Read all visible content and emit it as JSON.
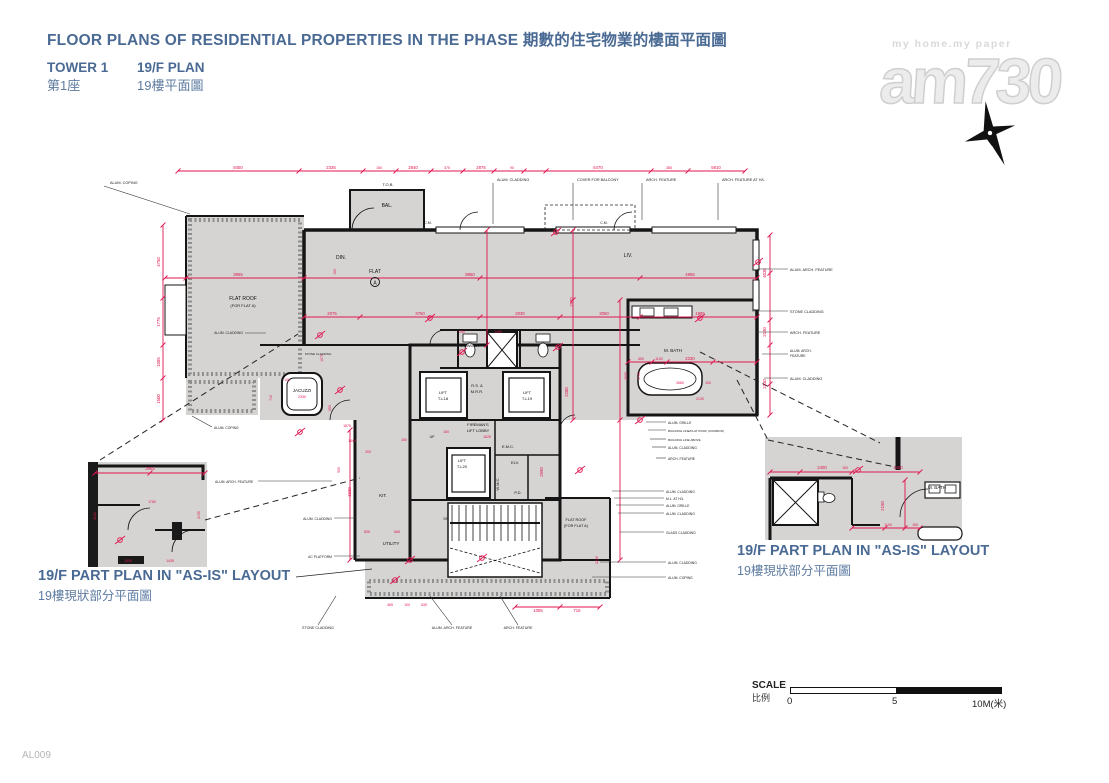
{
  "colors": {
    "accent_blue": "#4a6a94",
    "dim_red": "#e0164f",
    "floor_gray": "#d6d4d2",
    "wall_black": "#151515"
  },
  "header": {
    "title": "FLOOR PLANS OF RESIDENTIAL PROPERTIES IN THE PHASE 期數的住宅物業的樓面平面圖",
    "tower_en": "TOWER 1",
    "floor_en": "19/F PLAN",
    "tower_zh": "第1座",
    "floor_zh": "19樓平面圖"
  },
  "watermark": {
    "tagline": "my home.my paper",
    "brand": "am730"
  },
  "sheet_code": "AL009",
  "part_plans": {
    "left": {
      "en": "19/F PART PLAN IN \"AS-IS\" LAYOUT",
      "zh": "19樓現狀部分平面圖"
    },
    "right": {
      "en": "19/F PART PLAN IN \"AS-IS\" LAYOUT",
      "zh": "19樓現狀部分平面圖"
    }
  },
  "scale": {
    "en": "SCALE",
    "zh": "比例",
    "t0": "0",
    "t5": "5",
    "t10": "10M(米)"
  },
  "plan": {
    "unit": "A",
    "dims": [
      {
        "t": "8450",
        "x": 238,
        "y": 169
      },
      {
        "t": "2335",
        "x": 331,
        "y": 169
      },
      {
        "t": "150",
        "x": 379,
        "y": 169,
        "s": 3.5
      },
      {
        "t": "2840",
        "x": 413,
        "y": 169
      },
      {
        "t": "375",
        "x": 447,
        "y": 169,
        "s": 3.5
      },
      {
        "t": "2875",
        "x": 481,
        "y": 169
      },
      {
        "t": "90",
        "x": 512,
        "y": 169,
        "s": 3.5
      },
      {
        "t": "6470",
        "x": 598,
        "y": 169
      },
      {
        "t": "385",
        "x": 669,
        "y": 169,
        "s": 3.5
      },
      {
        "t": "5810",
        "x": 716,
        "y": 169
      },
      {
        "t": "4750",
        "x": 160,
        "y": 262,
        "r": -90
      },
      {
        "t": "1775",
        "x": 160,
        "y": 322,
        "r": -90
      },
      {
        "t": "1085",
        "x": 160,
        "y": 362,
        "r": -90
      },
      {
        "t": "1500",
        "x": 160,
        "y": 399,
        "r": -90
      },
      {
        "t": "3965",
        "x": 238,
        "y": 276
      },
      {
        "t": "8950",
        "x": 470,
        "y": 276
      },
      {
        "t": "4955",
        "x": 690,
        "y": 276
      },
      {
        "t": "150",
        "x": 336,
        "y": 272,
        "r": -90,
        "s": 3.5
      },
      {
        "t": "2075",
        "x": 332,
        "y": 315
      },
      {
        "t": "3750",
        "x": 420,
        "y": 315
      },
      {
        "t": "2030",
        "x": 520,
        "y": 315
      },
      {
        "t": "3050",
        "x": 604,
        "y": 315
      },
      {
        "t": "1985",
        "x": 700,
        "y": 315
      },
      {
        "t": "4030",
        "x": 766,
        "y": 273,
        "r": -90
      },
      {
        "t": "2130",
        "x": 766,
        "y": 332,
        "r": -90
      },
      {
        "t": "2330",
        "x": 766,
        "y": 384,
        "r": -90
      },
      {
        "t": "650",
        "x": 641,
        "y": 360,
        "s": 3.5
      },
      {
        "t": "1100",
        "x": 659,
        "y": 360,
        "s": 3.5
      },
      {
        "t": "2330",
        "x": 690,
        "y": 360
      },
      {
        "t": "2680",
        "x": 680,
        "y": 384,
        "s": 3.5
      },
      {
        "t": "100",
        "x": 708,
        "y": 384,
        "s": 3.5
      },
      {
        "t": "2130",
        "x": 700,
        "y": 400,
        "s": 3.5
      },
      {
        "t": "250",
        "x": 462,
        "y": 333,
        "s": 3.5
      },
      {
        "t": "1400",
        "x": 498,
        "y": 333,
        "s": 3.5
      },
      {
        "t": "2970",
        "x": 573,
        "y": 302,
        "r": -90
      },
      {
        "t": "2280",
        "x": 568,
        "y": 392,
        "r": -90
      },
      {
        "t": "1625",
        "x": 487,
        "y": 438,
        "s": 3.5
      },
      {
        "t": "150",
        "x": 446,
        "y": 433,
        "s": 3.5
      },
      {
        "t": "2590",
        "x": 543,
        "y": 472,
        "r": -90
      },
      {
        "t": "2330",
        "x": 302,
        "y": 398,
        "s": 3.5
      },
      {
        "t": "100",
        "x": 287,
        "y": 381,
        "s": 3.5
      },
      {
        "t": "655",
        "x": 331,
        "y": 408,
        "r": -90,
        "s": 3.5
      },
      {
        "t": "715",
        "x": 272,
        "y": 398,
        "r": -90,
        "s": 3.5
      },
      {
        "t": "1075",
        "x": 323,
        "y": 358,
        "r": -90,
        "s": 3.5
      },
      {
        "t": "1440",
        "x": 352,
        "y": 442,
        "s": 3.5
      },
      {
        "t": "905",
        "x": 340,
        "y": 470,
        "r": -90,
        "s": 3.5
      },
      {
        "t": "200",
        "x": 368,
        "y": 453,
        "s": 3.5
      },
      {
        "t": "1875",
        "x": 347,
        "y": 427,
        "s": 3.5
      },
      {
        "t": "3330",
        "x": 351,
        "y": 492,
        "r": -90
      },
      {
        "t": "665",
        "x": 397,
        "y": 533,
        "s": 3.5
      },
      {
        "t": "805",
        "x": 367,
        "y": 533,
        "s": 3.5
      },
      {
        "t": "150",
        "x": 404,
        "y": 441,
        "s": 3.5
      },
      {
        "t": "465",
        "x": 390,
        "y": 606,
        "s": 3.5
      },
      {
        "t": "100",
        "x": 407,
        "y": 606,
        "s": 3.5
      },
      {
        "t": "635",
        "x": 424,
        "y": 606,
        "s": 3.5
      },
      {
        "t": "1085",
        "x": 538,
        "y": 612
      },
      {
        "t": "715",
        "x": 577,
        "y": 612
      },
      {
        "t": "2230",
        "x": 598,
        "y": 560,
        "r": -90,
        "s": 3.5
      },
      {
        "t": "3965",
        "x": 150,
        "y": 470
      },
      {
        "t": "1780",
        "x": 152,
        "y": 503,
        "s": 3.5
      },
      {
        "t": "2195",
        "x": 200,
        "y": 515,
        "r": -90,
        "s": 3.5
      },
      {
        "t": "1430",
        "x": 128,
        "y": 562,
        "s": 3.5
      },
      {
        "t": "1435",
        "x": 170,
        "y": 562,
        "s": 3.5
      },
      {
        "t": "3100",
        "x": 96,
        "y": 516,
        "r": -90,
        "s": 3.5
      },
      {
        "t": "2400",
        "x": 822,
        "y": 469
      },
      {
        "t": "150",
        "x": 845,
        "y": 469,
        "s": 3.5
      },
      {
        "t": "4400",
        "x": 898,
        "y": 469
      },
      {
        "t": "2190",
        "x": 884,
        "y": 506,
        "r": -90
      },
      {
        "t": "1100",
        "x": 888,
        "y": 526,
        "s": 3.5
      },
      {
        "t": "150",
        "x": 915,
        "y": 526,
        "s": 3.5
      },
      {
        "t": "2690",
        "x": 627,
        "y": 376,
        "r": -90,
        "s": 3.5
      },
      {
        "t": "1700",
        "x": 640,
        "y": 376,
        "r": -90,
        "s": 3.5
      }
    ],
    "rooms": [
      {
        "t": "FLAT ROOF",
        "x": 243,
        "y": 300
      },
      {
        "t": "(FOR FLAT A)",
        "x": 243,
        "y": 307,
        "s": 4
      },
      {
        "t": "DIN.",
        "x": 341,
        "y": 259
      },
      {
        "t": "LIV.",
        "x": 628,
        "y": 257
      },
      {
        "t": "FLAT",
        "x": 375,
        "y": 273
      },
      {
        "t": "BAL.",
        "x": 387,
        "y": 207
      },
      {
        "t": "T.O.B.",
        "x": 388,
        "y": 186,
        "s": 4
      },
      {
        "t": "C.M.",
        "x": 428,
        "y": 224,
        "s": 3.5
      },
      {
        "t": "C.M.",
        "x": 604,
        "y": 224,
        "s": 3.5
      },
      {
        "t": "JACUZZI",
        "x": 302,
        "y": 392,
        "s": 4.5
      },
      {
        "t": "POWDER",
        "x": 470,
        "y": 347,
        "s": 4
      },
      {
        "t": "R.S. &",
        "x": 477,
        "y": 387,
        "s": 4
      },
      {
        "t": "M.R.R.",
        "x": 477,
        "y": 393,
        "s": 4
      },
      {
        "t": "LIFT",
        "x": 443,
        "y": 394,
        "s": 4
      },
      {
        "t": "T-L18",
        "x": 443,
        "y": 400,
        "s": 4
      },
      {
        "t": "LIFT",
        "x": 527,
        "y": 394,
        "s": 4
      },
      {
        "t": "T-L19",
        "x": 527,
        "y": 400,
        "s": 4
      },
      {
        "t": "FIREMAN'S",
        "x": 478,
        "y": 426,
        "s": 4
      },
      {
        "t": "LIFT LOBBY",
        "x": 478,
        "y": 432,
        "s": 4
      },
      {
        "t": "LIFT",
        "x": 462,
        "y": 462,
        "s": 4
      },
      {
        "t": "T-L20",
        "x": 462,
        "y": 468,
        "s": 4
      },
      {
        "t": "E.M.C.",
        "x": 508,
        "y": 448,
        "s": 4
      },
      {
        "t": "ELV.",
        "x": 515,
        "y": 464,
        "s": 4
      },
      {
        "t": "W.M.C.",
        "x": 499,
        "y": 484,
        "s": 4,
        "r": -90
      },
      {
        "t": "P.D.",
        "x": 518,
        "y": 494,
        "s": 4
      },
      {
        "t": "KIT.",
        "x": 383,
        "y": 497,
        "s": 4.5
      },
      {
        "t": "UTILITY",
        "x": 391,
        "y": 545,
        "s": 4.5
      },
      {
        "t": "M. BATH",
        "x": 673,
        "y": 352,
        "s": 4.5
      },
      {
        "t": "FLAT ROOF",
        "x": 576,
        "y": 521,
        "s": 3.8
      },
      {
        "t": "(FOR FLAT A)",
        "x": 576,
        "y": 527,
        "s": 3.8
      },
      {
        "t": "M. BATH",
        "x": 937,
        "y": 489,
        "s": 4.5
      },
      {
        "t": "UP",
        "x": 432,
        "y": 438,
        "s": 3.5
      },
      {
        "t": "DN",
        "x": 446,
        "y": 520,
        "s": 3.5
      }
    ],
    "callouts": [
      {
        "t": "ALUM. COPING",
        "x": 110,
        "y": 184,
        "l": [
          104,
          186,
          190,
          214
        ]
      },
      {
        "t": "ALUM. CLADDING",
        "x": 497,
        "y": 181,
        "l": [
          493,
          183,
          493,
          224
        ]
      },
      {
        "t": "COVER FOR BALCONY",
        "x": 577,
        "y": 181,
        "l": [
          573,
          183,
          573,
          220
        ]
      },
      {
        "t": "ARCH. FEATURE",
        "x": 646,
        "y": 181,
        "l": [
          642,
          183,
          642,
          220
        ]
      },
      {
        "t": "ARCH. FEATURE AT H/L",
        "x": 722,
        "y": 181,
        "l": [
          718,
          183,
          718,
          220
        ]
      },
      {
        "t": "ALUM. ARCH. FEATURE",
        "x": 790,
        "y": 271,
        "l": [
          788,
          269,
          757,
          269
        ]
      },
      {
        "t": "STONE CLADDING",
        "x": 790,
        "y": 313,
        "l": [
          788,
          311,
          752,
          311
        ]
      },
      {
        "t": "ARCH. FEATURE",
        "x": 790,
        "y": 334,
        "l": [
          788,
          332,
          757,
          332
        ]
      },
      {
        "t": "ALUM. ARCH.",
        "x": 790,
        "y": 352,
        "s": 3.4
      },
      {
        "t": "FEATURE",
        "x": 790,
        "y": 357,
        "s": 3.4,
        "l": [
          788,
          354,
          762,
          354
        ]
      },
      {
        "t": "ALUM. CLADDING",
        "x": 790,
        "y": 380,
        "l": [
          788,
          378,
          764,
          378
        ]
      },
      {
        "t": "ALUM. GRILLE",
        "x": 668,
        "y": 424,
        "s": 3.4,
        "l": [
          666,
          422,
          646,
          422
        ]
      },
      {
        "t": "BUILDING LINE/FLAT ROOF (COMMON)",
        "x": 668,
        "y": 432,
        "s": 3,
        "l": [
          666,
          430,
          648,
          430
        ]
      },
      {
        "t": "BUILDING LINE ABOVE",
        "x": 668,
        "y": 441,
        "s": 3,
        "l": [
          666,
          439,
          650,
          439
        ]
      },
      {
        "t": "ALUM. CLADDING",
        "x": 668,
        "y": 449,
        "s": 3.4,
        "l": [
          666,
          447,
          652,
          447
        ]
      },
      {
        "t": "ARCH. FEATURE",
        "x": 668,
        "y": 460,
        "s": 3.4,
        "l": [
          666,
          458,
          656,
          458
        ]
      },
      {
        "t": "ALUM. CLADDING",
        "x": 666,
        "y": 493,
        "s": 3.4,
        "l": [
          664,
          491,
          612,
          491
        ]
      },
      {
        "t": "M.L. AT H/L",
        "x": 666,
        "y": 500,
        "s": 3.4,
        "l": [
          664,
          498,
          614,
          498
        ]
      },
      {
        "t": "ALUM. GRILLE",
        "x": 666,
        "y": 507,
        "s": 3.4,
        "l": [
          664,
          505,
          616,
          505
        ]
      },
      {
        "t": "ALUM. CLADDING",
        "x": 666,
        "y": 515,
        "s": 3.4,
        "l": [
          664,
          513,
          618,
          513
        ]
      },
      {
        "t": "GLASS CLADDING",
        "x": 666,
        "y": 534,
        "s": 3.4,
        "l": [
          664,
          532,
          620,
          532
        ]
      },
      {
        "t": "ALUM. CLADDING",
        "x": 668,
        "y": 564,
        "s": 3.4,
        "l": [
          666,
          562,
          600,
          562
        ]
      },
      {
        "t": "ALUM. COPING",
        "x": 668,
        "y": 579,
        "s": 3.4,
        "l": [
          666,
          577,
          592,
          577
        ]
      },
      {
        "t": "ALUM. CLADDING",
        "x": 332,
        "y": 520,
        "a": "end",
        "s": 3.4,
        "l": [
          334,
          518,
          356,
          518
        ]
      },
      {
        "t": "AC PLATFORM",
        "x": 332,
        "y": 558,
        "a": "end",
        "s": 3.4,
        "l": [
          334,
          556,
          360,
          556
        ]
      },
      {
        "t": "STONE CLADDING",
        "x": 318,
        "y": 629,
        "a": "middle",
        "s": 3.6,
        "l": [
          318,
          625,
          336,
          596
        ]
      },
      {
        "t": "ALUM. ARCH. FEATURE",
        "x": 452,
        "y": 629,
        "a": "middle",
        "s": 3.6,
        "l": [
          452,
          625,
          430,
          596
        ]
      },
      {
        "t": "ARCH. FEATURE",
        "x": 518,
        "y": 629,
        "a": "middle",
        "s": 3.6,
        "l": [
          518,
          625,
          500,
          596
        ]
      },
      {
        "t": "ALUM. ARCH. FEATURE",
        "x": 215,
        "y": 483,
        "s": 3.4,
        "l": [
          258,
          481,
          332,
          481
        ]
      },
      {
        "t": "ALUM. COPING",
        "x": 214,
        "y": 429,
        "s": 3.4,
        "l": [
          212,
          427,
          192,
          416
        ]
      },
      {
        "t": "ALUM. CLADDING",
        "x": 243,
        "y": 334,
        "a": "end",
        "s": 3.4,
        "l": [
          245,
          333,
          266,
          333
        ]
      },
      {
        "t": "STONE CLADDING",
        "x": 318,
        "y": 355,
        "a": "middle",
        "s": 3
      }
    ]
  }
}
